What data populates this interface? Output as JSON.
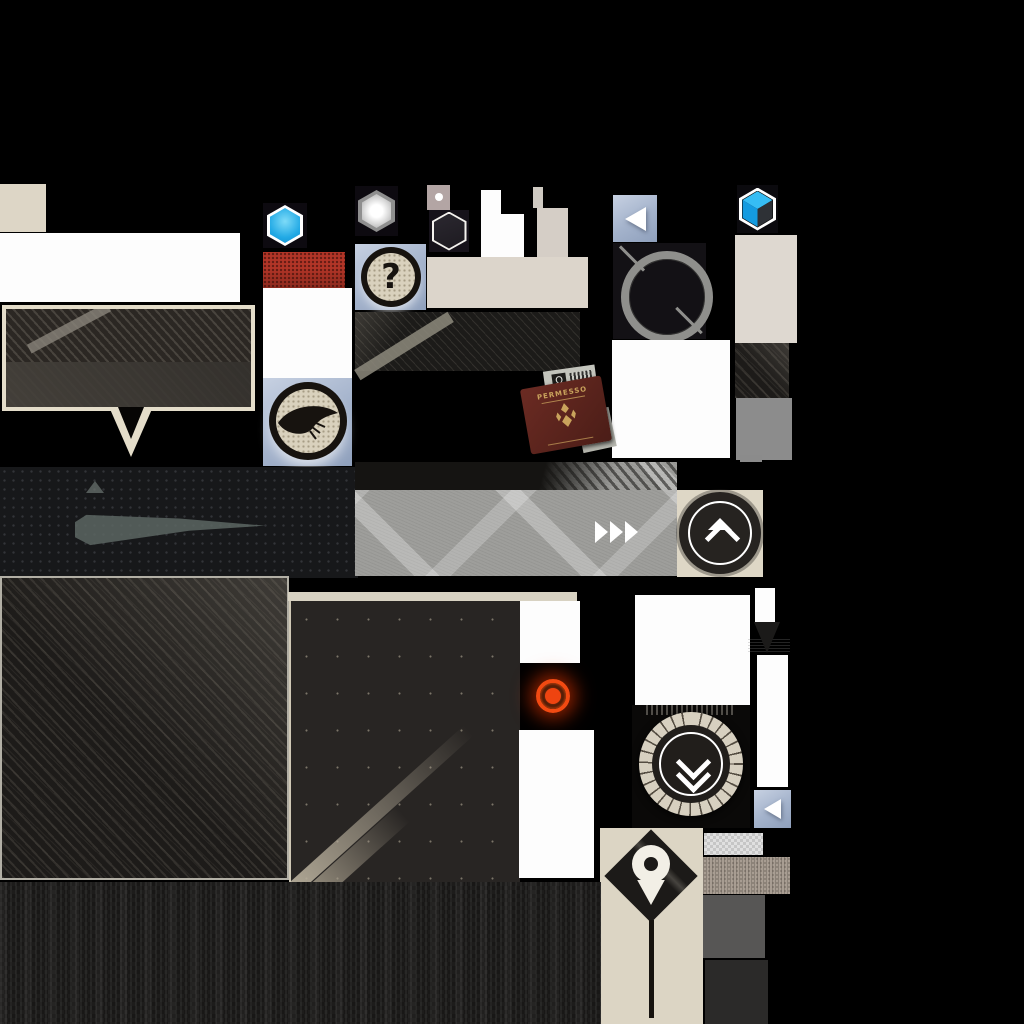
{
  "canvas": {
    "width": 1024,
    "height": 1024,
    "background": "#000000"
  },
  "colors": {
    "bg": "#000000",
    "beige": "#ddd6c6",
    "steel": "#a9b8d1",
    "accent-blue": "#22aee8",
    "red-swatch": "#b23527",
    "alert-red": "#f2460f",
    "ink": "#211e1c",
    "banner-gray": "#9e9e9b",
    "gray-mid": "#8c8c8c",
    "gray-deep": "#575655",
    "gold": "#c9a35c",
    "passport-maroon": "#5d241f"
  },
  "icons": {
    "question_glyph": "?",
    "stamp_glyph": "Ω"
  },
  "passport": {
    "title": "PERMESSO"
  }
}
